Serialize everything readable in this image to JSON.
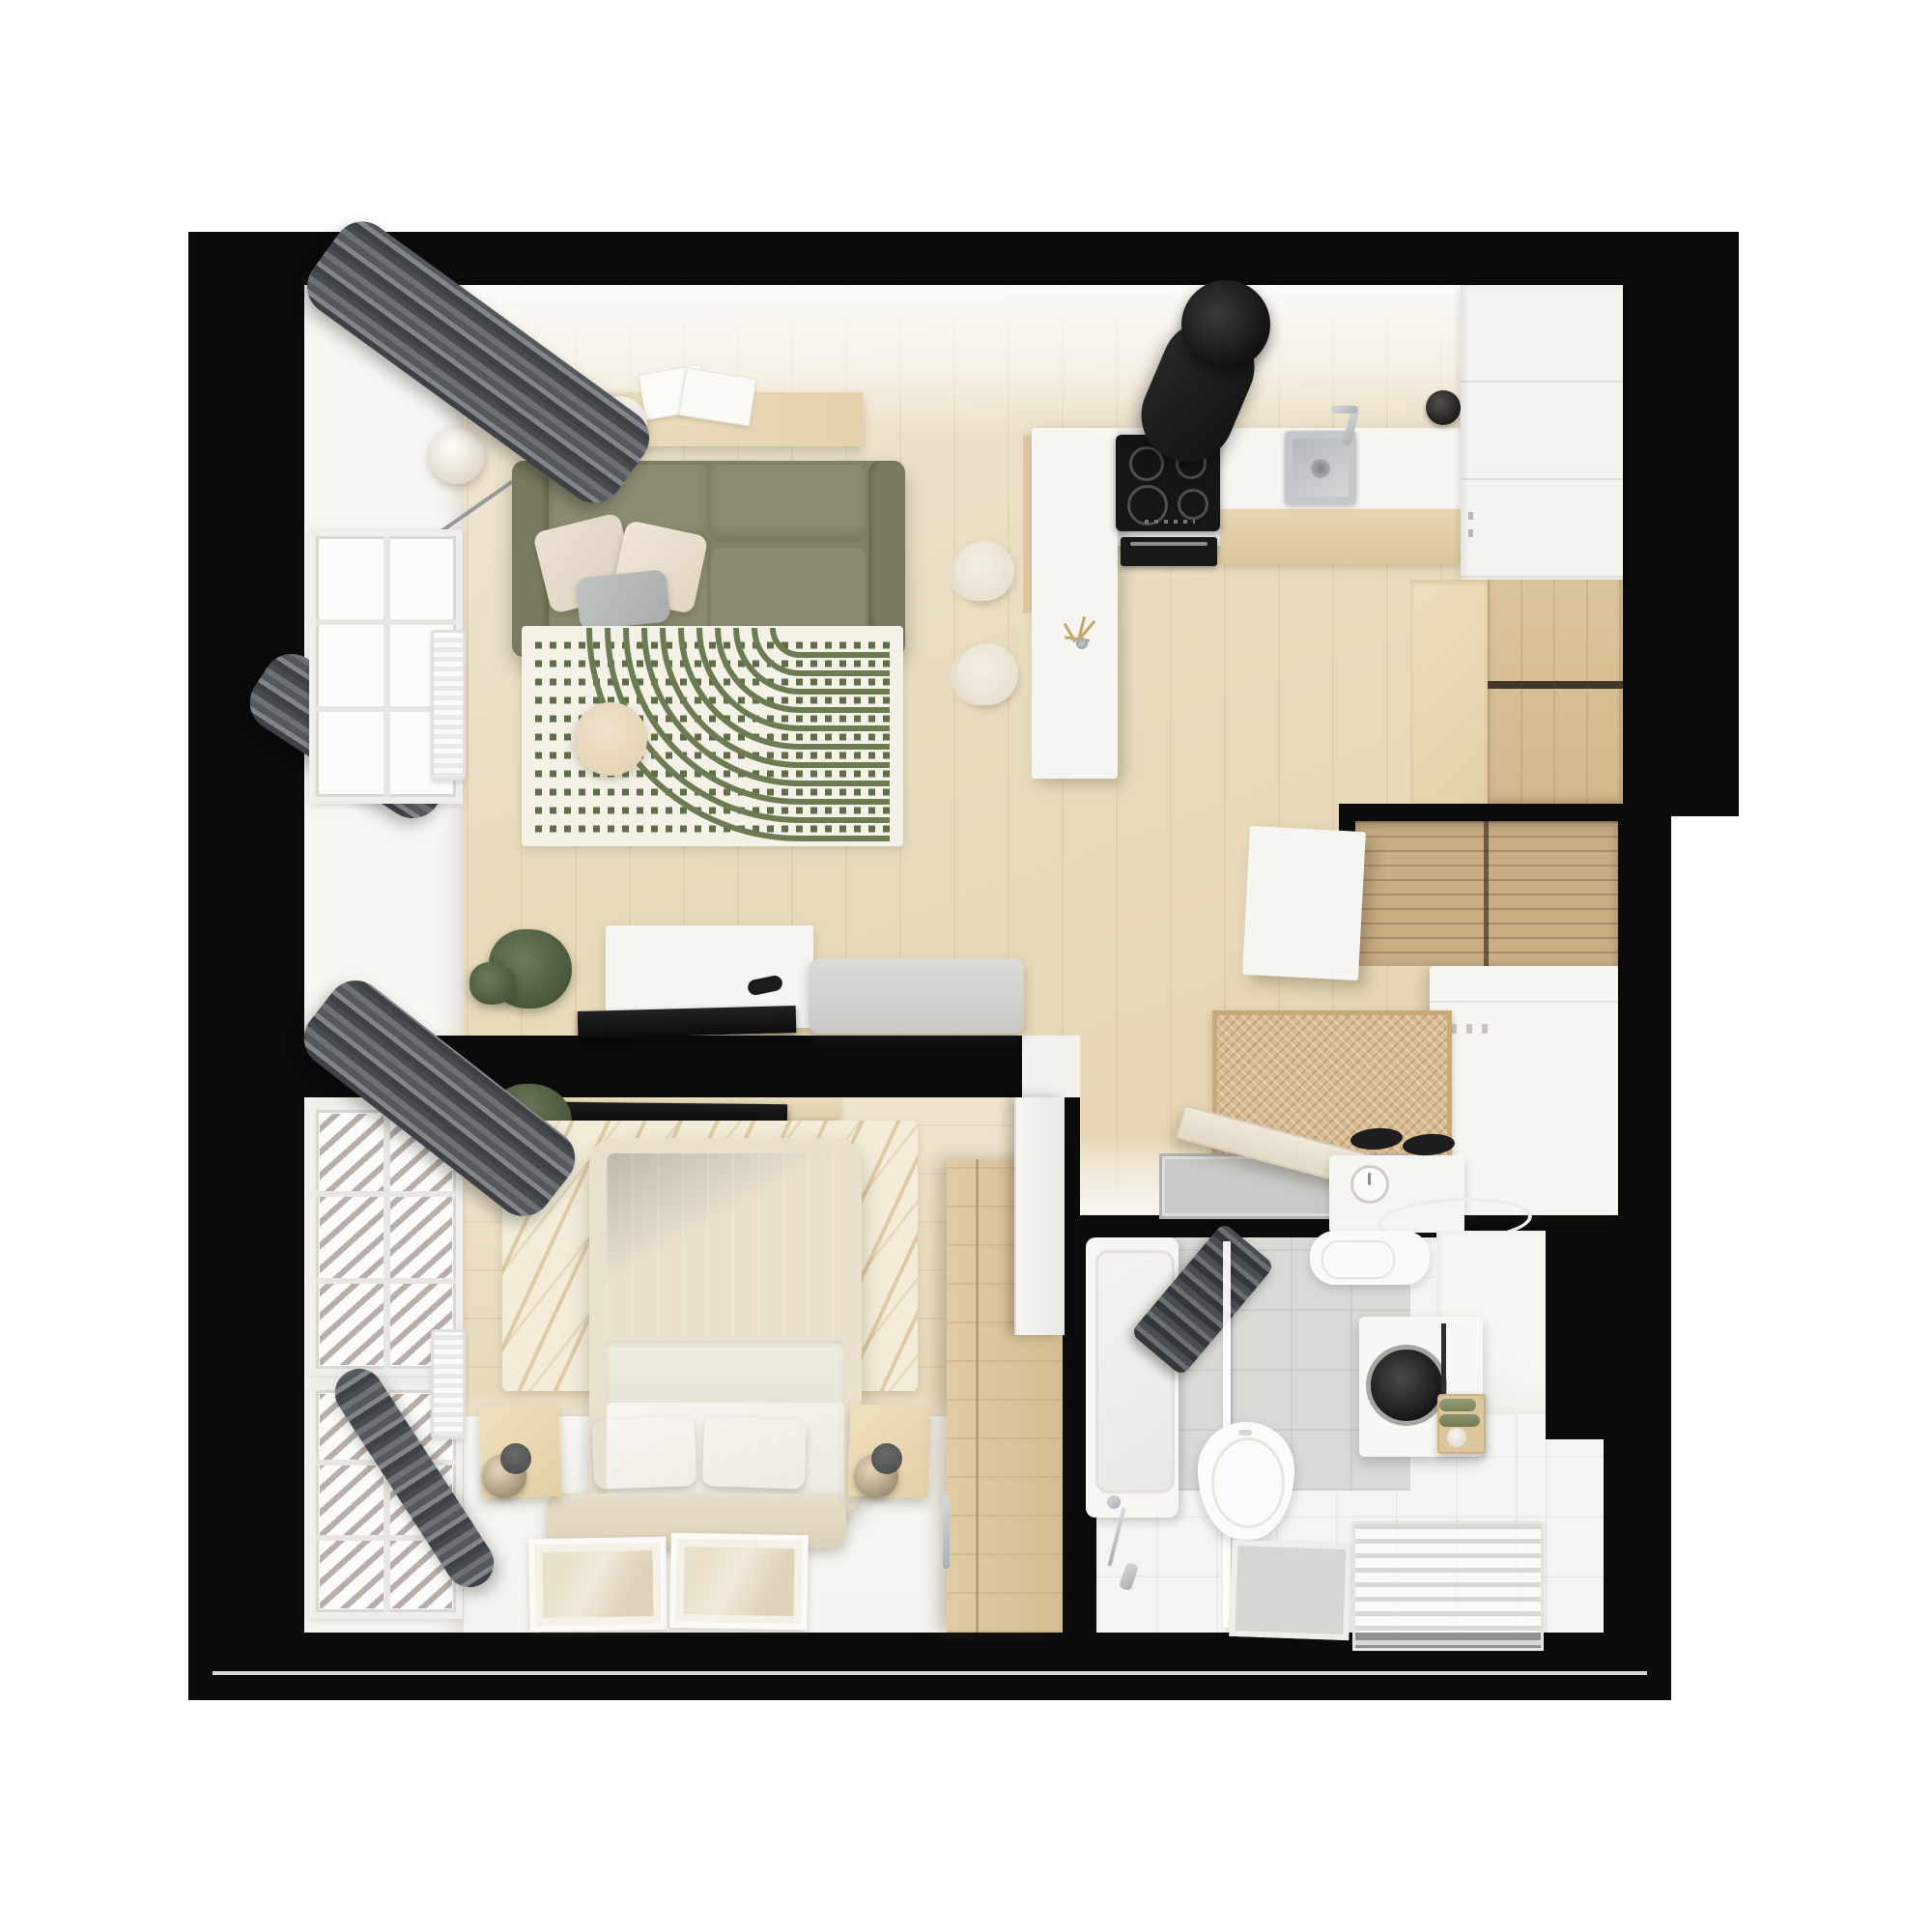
{
  "scene": {
    "title": "Top-down 3D render floor plan of a small one-bedroom apartment",
    "view": "top-down",
    "canvas": "2000x2000",
    "background": "#ffffff"
  },
  "palette": {
    "wall_black": "#0b0b0b",
    "wood_floor": "#e9dcbe",
    "wood_cabinet": "#d2b88d",
    "white_surface": "#f6f5f2",
    "sofa_olive": "#85866b",
    "duvet_olive": "#999b7d",
    "rug_cream": "#f3f0e5",
    "rug_pattern_olive": "#6d7b52",
    "curtain_gray": "#55585d",
    "tile_gray": "#d9d9d6",
    "steel": "#c4c8ca",
    "appliance_black": "#151515",
    "herringbone_tan": "#d8bb90"
  },
  "rooms": {
    "living_room": {
      "label": "Living room",
      "items": [
        "gray curtains",
        "window",
        "radiator",
        "floor lamp",
        "wall console with eucalyptus bowl and papers",
        "olive two-seat sofa",
        "beige and gray throw pillows",
        "cream rug with olive arcs and dotted lines",
        "round side table",
        "white media sideboard",
        "black remote",
        "flat TV panel",
        "gray bench",
        "potted plant"
      ]
    },
    "kitchen": {
      "label": "Kitchen",
      "items": [
        "white peninsula counter",
        "two wishbone bar chairs",
        "twig decor on counter",
        "induction cooktop",
        "tilted cylinder range hood",
        "built-in oven",
        "stainless steel sink",
        "chrome faucet",
        "black kettle",
        "tall white cabinet column",
        "wood base cabinets",
        "wood corner cabinets"
      ]
    },
    "hallway": {
      "label": "Entry hall",
      "items": [
        "wood sliding-door wardrobe niche",
        "white freestanding wardrobe",
        "herringbone doormat",
        "white console cabinet",
        "shoe box with dial scale",
        "oval floor tray",
        "recessed gray doormat",
        "open entry door"
      ]
    },
    "bedroom": {
      "label": "Bedroom",
      "items": [
        "double bed with olive striped duvet",
        "white folded sheet and blanket",
        "two olive pillows",
        "foot bench",
        "two wood nightstands",
        "glass sphere lamps",
        "cream shaggy rug with wavy lines",
        "wood wardrobe",
        "TV shelf with flat TV",
        "two art frames on floor",
        "two windows with railing view",
        "radiator",
        "gray curtains",
        "potted plant",
        "open white door"
      ]
    },
    "bathroom": {
      "label": "Bathroom",
      "items": [
        "bathtub",
        "chrome shower set",
        "glass shower screen",
        "dark hanging towel",
        "toilet",
        "bath mat",
        "washbasin",
        "white bathroom cabinet",
        "washing machine",
        "wood caddy with green towels",
        "towel ladder rack",
        "gray wall tiles",
        "white floor tiles"
      ]
    }
  }
}
